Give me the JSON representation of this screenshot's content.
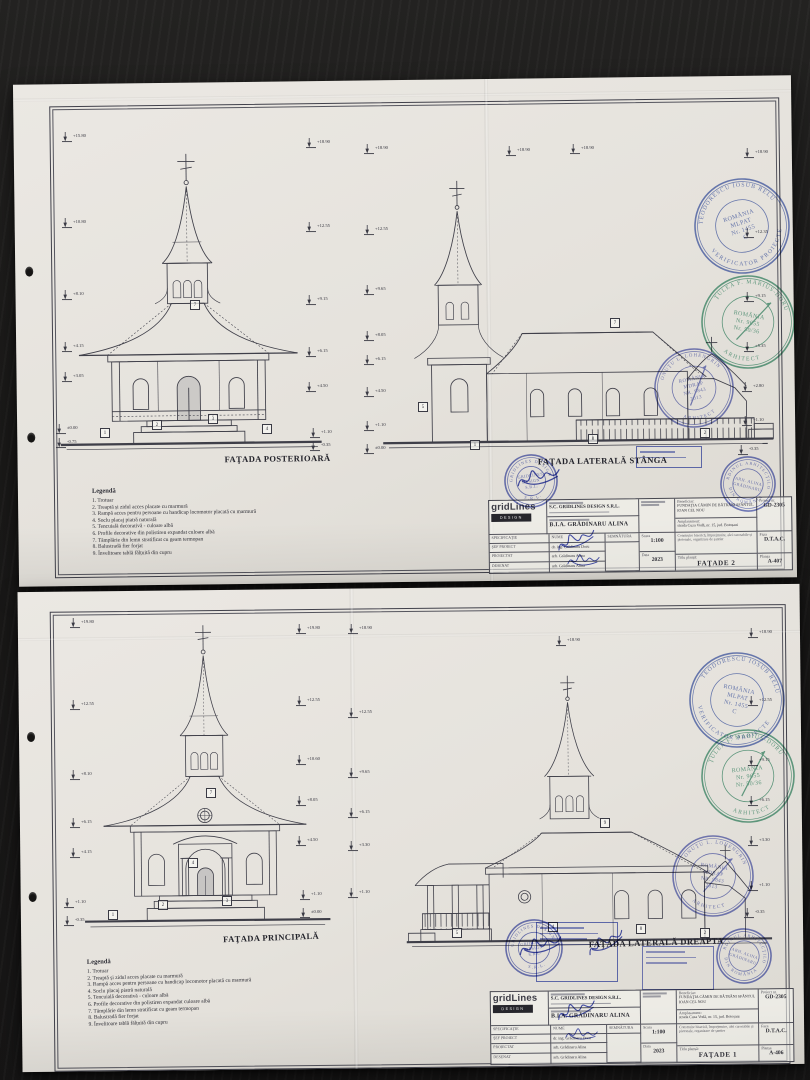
{
  "sheet1": {
    "drawings": {
      "left_title": "FAŢADA POSTERIOARĂ",
      "right_title": "FAŢADA LATERALĂ STÂNGA"
    },
    "legend": {
      "title": "Legendă",
      "items": [
        "1. Trotuar",
        "2. Treaptă și zidul acces placate cu marmură",
        "3. Rampă acces pentru persoane cu handicap locomotor placată cu marmură",
        "4. Soclu placaj piatră naturală",
        "5. Tencuială decorativă - culoare albă",
        "6. Profile decorative din polistiren expandat culoare albă",
        "7. Tâmplărie din lemn stratificat cu geam termopan",
        "8. Balustradă fier forjat",
        "9. Învelitoare tablă fălțuită din cupru"
      ]
    },
    "titleblock": {
      "logo": "gridLines",
      "logo_badge": "DESIGN",
      "firm": "S.C. GRIDLINES DESIGN S.R.L.",
      "firm2": "B.I.A. GRĂDINARU ALINA",
      "spec_header": [
        "SPECIFICAŢIE",
        "NUME",
        "SEMNĂTURA"
      ],
      "rows": [
        [
          "ŞEF PROIECT",
          "dr. ing. Grădinaru Doru"
        ],
        [
          "PROIECTAT",
          "arh. Grădinaru Alina"
        ],
        [
          "DESENAT",
          "arh. Grădinaru Alina"
        ]
      ],
      "scara_label": "Scara",
      "scara": "1:100",
      "data_label": "Data",
      "data": "2023",
      "beneficiar_label": "Beneficiar:",
      "beneficiar": "FUNDAŢIA CĂMIN DE BĂTRÂNI SFÂNTUL IOAN CEL NOU",
      "amplasament_label": "Amplasament:",
      "amplasament": "strada Cuza Vodă, nr. 15, jud. Botoșani",
      "descriere": "Construire biserică, împrejmuire, alei carosabile și pietonale, organizare de șantier",
      "proiect_label": "Proiect nr.",
      "proiect": "GD-2305",
      "faza_label": "Faza",
      "faza": "D.T.A.C.",
      "titlu_label": "Titlu planșă:",
      "titlu": "FAŢADE 2",
      "plansa_label": "Planșa",
      "plansa": "A-407"
    },
    "markers": [
      {
        "t": "lvl",
        "x": 62,
        "y": 132,
        "v": "+15.80"
      },
      {
        "t": "lvl",
        "x": 62,
        "y": 218,
        "v": "+10.80"
      },
      {
        "t": "lvl",
        "x": 62,
        "y": 290,
        "v": "+8.10"
      },
      {
        "t": "lvl",
        "x": 62,
        "y": 342,
        "v": "+4.15"
      },
      {
        "t": "lvl",
        "x": 62,
        "y": 372,
        "v": "+3.05"
      },
      {
        "t": "lvl",
        "x": 56,
        "y": 424,
        "v": "±0.00"
      },
      {
        "t": "lvl",
        "x": 56,
        "y": 438,
        "v": "-0.75"
      },
      {
        "t": "lvl",
        "x": 306,
        "y": 138,
        "v": "+18.90"
      },
      {
        "t": "lvl",
        "x": 306,
        "y": 222,
        "v": "+12.55"
      },
      {
        "t": "lvl",
        "x": 306,
        "y": 295,
        "v": "+9.15"
      },
      {
        "t": "lvl",
        "x": 306,
        "y": 347,
        "v": "+6.15"
      },
      {
        "t": "lvl",
        "x": 306,
        "y": 382,
        "v": "+4.50"
      },
      {
        "t": "lvl",
        "x": 310,
        "y": 428,
        "v": "+1.10"
      },
      {
        "t": "lvl",
        "x": 310,
        "y": 441,
        "v": "-0.35"
      },
      {
        "t": "lvl",
        "x": 364,
        "y": 144,
        "v": "+18.90"
      },
      {
        "t": "lvl",
        "x": 364,
        "y": 225,
        "v": "+12.55"
      },
      {
        "t": "lvl",
        "x": 364,
        "y": 285,
        "v": "+9.65"
      },
      {
        "t": "lvl",
        "x": 364,
        "y": 331,
        "v": "+8.05"
      },
      {
        "t": "lvl",
        "x": 364,
        "y": 355,
        "v": "+6.15"
      },
      {
        "t": "lvl",
        "x": 364,
        "y": 387,
        "v": "+4.50"
      },
      {
        "t": "lvl",
        "x": 364,
        "y": 421,
        "v": "+1.10"
      },
      {
        "t": "lvl",
        "x": 364,
        "y": 444,
        "v": "±0.00"
      },
      {
        "t": "lvl",
        "x": 506,
        "y": 146,
        "v": "+18.90"
      },
      {
        "t": "lvl",
        "x": 570,
        "y": 144,
        "v": "+18.90"
      },
      {
        "t": "lvl",
        "x": 744,
        "y": 148,
        "v": "+18.90"
      },
      {
        "t": "lvl",
        "x": 744,
        "y": 228,
        "v": "+12.35"
      },
      {
        "t": "lvl",
        "x": 744,
        "y": 292,
        "v": "+9.15"
      },
      {
        "t": "lvl",
        "x": 744,
        "y": 342,
        "v": "+5.35"
      },
      {
        "t": "lvl",
        "x": 742,
        "y": 382,
        "v": "+2.80"
      },
      {
        "t": "lvl",
        "x": 742,
        "y": 416,
        "v": "+1.10"
      },
      {
        "t": "lvl",
        "x": 738,
        "y": 445,
        "v": "-0.35"
      },
      {
        "t": "box",
        "x": 100,
        "y": 428,
        "v": "1"
      },
      {
        "t": "box",
        "x": 152,
        "y": 420,
        "v": "2"
      },
      {
        "t": "box",
        "x": 208,
        "y": 414,
        "v": "3"
      },
      {
        "t": "box",
        "x": 262,
        "y": 424,
        "v": "4"
      },
      {
        "t": "box",
        "x": 190,
        "y": 300,
        "v": "7"
      },
      {
        "t": "box",
        "x": 418,
        "y": 402,
        "v": "5"
      },
      {
        "t": "box",
        "x": 470,
        "y": 440,
        "v": "1"
      },
      {
        "t": "box",
        "x": 588,
        "y": 434,
        "v": "8"
      },
      {
        "t": "box",
        "x": 700,
        "y": 428,
        "v": "2"
      },
      {
        "t": "box",
        "x": 610,
        "y": 318,
        "v": "7"
      }
    ]
  },
  "sheet2": {
    "drawings": {
      "left_title": "FAŢADA PRINCIPALĂ",
      "right_title": "FAŢADA LATERALĂ DREAPTA"
    },
    "legend": {
      "title": "Legendă",
      "items": [
        "1. Trotuar",
        "2. Treaptă și zidul acces placate cu marmură",
        "3. Rampă acces pentru persoane cu handicap locomotor placată cu marmură",
        "4. Soclu placaj piatră naturală",
        "5. Tencuială decorativă - culoare albă",
        "6. Profile decorative din polistiren expandat culoare albă",
        "7. Tâmplărie din lemn stratificat cu geam termopan",
        "8. Balustradă fier forjat",
        "9. Învelitoare tablă fălțuită din cupru"
      ]
    },
    "titleblock": {
      "logo": "gridLines",
      "logo_badge": "DESIGN",
      "firm": "S.C. GRIDLINES DESIGN S.R.L.",
      "firm2": "B.I.A. GRĂDINARU ALINA",
      "spec_header": [
        "SPECIFICAŢIE",
        "NUME",
        "SEMNĂTURA"
      ],
      "rows": [
        [
          "ŞEF PROIECT",
          "dr. ing. Grădinaru Doru"
        ],
        [
          "PROIECTAT",
          "arh. Grădinaru Alina"
        ],
        [
          "DESENAT",
          "arh. Grădinaru Alina"
        ]
      ],
      "scara_label": "Scara",
      "scara": "1:100",
      "data_label": "Data",
      "data": "2023",
      "beneficiar_label": "Beneficiar:",
      "beneficiar": "FUNDAŢIA CĂMIN DE BĂTRÂNI SFÂNTUL IOAN CEL NOU",
      "amplasament_label": "Amplasament:",
      "amplasament": "strada Cuza Vodă, nr. 15, jud. Botoșani",
      "descriere": "Construire biserică, împrejmuire, alei carosabile și pietonale, organizare de șantier",
      "proiect_label": "Proiect nr.",
      "proiect": "GD-2305",
      "faza_label": "Faza",
      "faza": "D.T.A.C.",
      "titlu_label": "Titlu planșă:",
      "titlu": "FAŢADE 1",
      "plansa_label": "Planșa",
      "plansa": "A-406"
    },
    "markers": [
      {
        "t": "lvl",
        "x": 70,
        "y": 618,
        "v": "+19.80"
      },
      {
        "t": "lvl",
        "x": 70,
        "y": 700,
        "v": "+12.55"
      },
      {
        "t": "lvl",
        "x": 70,
        "y": 770,
        "v": "+8.10"
      },
      {
        "t": "lvl",
        "x": 70,
        "y": 818,
        "v": "+6.15"
      },
      {
        "t": "lvl",
        "x": 70,
        "y": 848,
        "v": "+4.15"
      },
      {
        "t": "lvl",
        "x": 64,
        "y": 898,
        "v": "+1.10"
      },
      {
        "t": "lvl",
        "x": 64,
        "y": 916,
        "v": "-0.35"
      },
      {
        "t": "lvl",
        "x": 296,
        "y": 624,
        "v": "+19.80"
      },
      {
        "t": "lvl",
        "x": 296,
        "y": 696,
        "v": "+12.55"
      },
      {
        "t": "lvl",
        "x": 296,
        "y": 755,
        "v": "+10.60"
      },
      {
        "t": "lvl",
        "x": 296,
        "y": 796,
        "v": "+8.05"
      },
      {
        "t": "lvl",
        "x": 296,
        "y": 836,
        "v": "+4.50"
      },
      {
        "t": "lvl",
        "x": 300,
        "y": 890,
        "v": "+1.10"
      },
      {
        "t": "lvl",
        "x": 300,
        "y": 908,
        "v": "±0.00"
      },
      {
        "t": "lvl",
        "x": 348,
        "y": 624,
        "v": "+18.90"
      },
      {
        "t": "lvl",
        "x": 348,
        "y": 708,
        "v": "+12.55"
      },
      {
        "t": "lvl",
        "x": 348,
        "y": 768,
        "v": "+9.65"
      },
      {
        "t": "lvl",
        "x": 348,
        "y": 808,
        "v": "+6.15"
      },
      {
        "t": "lvl",
        "x": 348,
        "y": 841,
        "v": "+3.30"
      },
      {
        "t": "lvl",
        "x": 348,
        "y": 888,
        "v": "+1.10"
      },
      {
        "t": "lvl",
        "x": 556,
        "y": 636,
        "v": "+18.90"
      },
      {
        "t": "lvl",
        "x": 748,
        "y": 628,
        "v": "+18.90"
      },
      {
        "t": "lvl",
        "x": 748,
        "y": 696,
        "v": "+12.55"
      },
      {
        "t": "lvl",
        "x": 748,
        "y": 756,
        "v": "+9.15"
      },
      {
        "t": "lvl",
        "x": 748,
        "y": 796,
        "v": "+6.15"
      },
      {
        "t": "lvl",
        "x": 748,
        "y": 836,
        "v": "+3.30"
      },
      {
        "t": "lvl",
        "x": 748,
        "y": 881,
        "v": "+1.10"
      },
      {
        "t": "lvl",
        "x": 744,
        "y": 908,
        "v": "-0.35"
      },
      {
        "t": "box",
        "x": 108,
        "y": 910,
        "v": "1"
      },
      {
        "t": "box",
        "x": 158,
        "y": 900,
        "v": "2"
      },
      {
        "t": "box",
        "x": 222,
        "y": 896,
        "v": "3"
      },
      {
        "t": "box",
        "x": 188,
        "y": 858,
        "v": "4"
      },
      {
        "t": "box",
        "x": 206,
        "y": 788,
        "v": "7"
      },
      {
        "t": "box",
        "x": 452,
        "y": 928,
        "v": "5"
      },
      {
        "t": "box",
        "x": 548,
        "y": 922,
        "v": "4"
      },
      {
        "t": "box",
        "x": 636,
        "y": 924,
        "v": "8"
      },
      {
        "t": "box",
        "x": 700,
        "y": 928,
        "v": "2"
      },
      {
        "t": "box",
        "x": 600,
        "y": 818,
        "v": "9"
      }
    ]
  },
  "stamps": [
    {
      "name": "verificator-stamp-teodorescu",
      "col": "#3a55b0",
      "x": 742,
      "y": 226,
      "r": 47,
      "rot": -18,
      "top": "TEODORESCU IOSUB RELU",
      "bottom": "VERIFICATOR PROIECTE",
      "center": [
        "ROMÂNIA",
        "MLPAT",
        "Nr. 1455",
        "C"
      ]
    },
    {
      "name": "arhitect-stamp-tulea",
      "col": "#2f8a66",
      "x": 748,
      "y": 322,
      "r": 46,
      "rot": 10,
      "needle": 1,
      "top": "ŢULEA F. MARIUS-DORU",
      "bottom": "ARHITECT",
      "center": [
        "ROMÂNIA",
        "Nr. 9655",
        "Nr. 50/36"
      ]
    },
    {
      "name": "arhitect-stamp-onutu",
      "col": "#4a55b5",
      "x": 694,
      "y": 388,
      "r": 39,
      "rot": -12,
      "needle": 1,
      "top": "ONUŢU L. LOHENGRIN",
      "bottom": "ARHITECT",
      "center": [
        "ROMÂNIA",
        "MDRAP",
        "NR. 9843",
        "2013"
      ]
    },
    {
      "name": "company-round-stamp",
      "col": "#3c4ab0",
      "x": 531,
      "y": 481,
      "r": 26,
      "rot": -8,
      "top": "GRIDLINES DESIGN",
      "bottom": "S.R.L.",
      "center": [
        "GRIDLINES",
        "DESIGN",
        "S.R.L."
      ]
    },
    {
      "name": "oar-stamp",
      "col": "#4250b4",
      "x": 748,
      "y": 484,
      "r": 27,
      "rot": 14,
      "top": "ORDINUL ARHITECŢILOR",
      "bottom": "DIN ROMÂNIA",
      "center": [
        "ARH. ALINA",
        "GRĂDINARU"
      ]
    },
    {
      "name": "verificator-stamp-teodorescu",
      "col": "#3a55b0",
      "x": 737,
      "y": 700,
      "r": 47,
      "rot": 12,
      "top": "TEODORESCU IOSUB RELU",
      "bottom": "VERIFICATOR PROIECTE",
      "center": [
        "ROMÂNIA",
        "MLPAT",
        "Nr. 1455",
        "C"
      ]
    },
    {
      "name": "arhitect-stamp-tulea",
      "col": "#2f8a66",
      "x": 748,
      "y": 776,
      "r": 46,
      "rot": -6,
      "needle": 1,
      "top": "ŢULEA F. MARIUS-DORU",
      "bottom": "ARHITECT",
      "center": [
        "ROMÂNIA",
        "Nr. 9655",
        "Nr. 50/36"
      ]
    },
    {
      "name": "arhitect-stamp-onutu",
      "col": "#4a55b5",
      "x": 713,
      "y": 876,
      "r": 40,
      "rot": 8,
      "needle": 1,
      "top": "ONUŢU L. LOHENGRIN",
      "bottom": "ARHITECT",
      "center": [
        "ROMÂNIA",
        "MDRAP",
        "NR. 9843",
        "2013"
      ]
    },
    {
      "name": "company-round-stamp",
      "col": "#3c4ab0",
      "x": 534,
      "y": 948,
      "r": 28,
      "rot": -10,
      "top": "GRIDLINES DESIGN",
      "bottom": "S.R.L.",
      "center": [
        "GRIDLINES",
        "DESIGN",
        "S.R.L."
      ]
    },
    {
      "name": "oar-stamp",
      "col": "#4250b4",
      "x": 744,
      "y": 956,
      "r": 27,
      "rot": 20,
      "top": "ORDINUL ARHITECŢILOR",
      "bottom": "DIN ROMÂNIA",
      "center": [
        "ARH. ALINA",
        "GRĂDINARU"
      ]
    }
  ],
  "rect_stamps": [
    {
      "name": "rect-stamp-small",
      "x": 636,
      "y": 446,
      "w": 64,
      "h": 20,
      "col": "#4353b8",
      "lines": 2
    },
    {
      "name": "rect-stamp-large",
      "x": 536,
      "y": 922,
      "w": 80,
      "h": 58,
      "col": "#4353b8",
      "lines": 4
    },
    {
      "name": "rect-stamp-medium",
      "x": 642,
      "y": 946,
      "w": 70,
      "h": 42,
      "col": "#5a66c0",
      "lines": 3
    }
  ],
  "signatures": [
    {
      "x": 556,
      "y": 528,
      "s": 1.0,
      "rot": -12
    },
    {
      "x": 562,
      "y": 548,
      "s": 0.8,
      "rot": 6
    },
    {
      "x": 518,
      "y": 466,
      "s": 1.1,
      "rot": -4
    },
    {
      "x": 556,
      "y": 998,
      "s": 1.0,
      "rot": -10
    },
    {
      "x": 560,
      "y": 1022,
      "s": 0.8,
      "rot": 8
    },
    {
      "x": 520,
      "y": 934,
      "s": 1.1,
      "rot": -6
    },
    {
      "x": 586,
      "y": 930,
      "s": 1.0,
      "rot": -20
    }
  ]
}
